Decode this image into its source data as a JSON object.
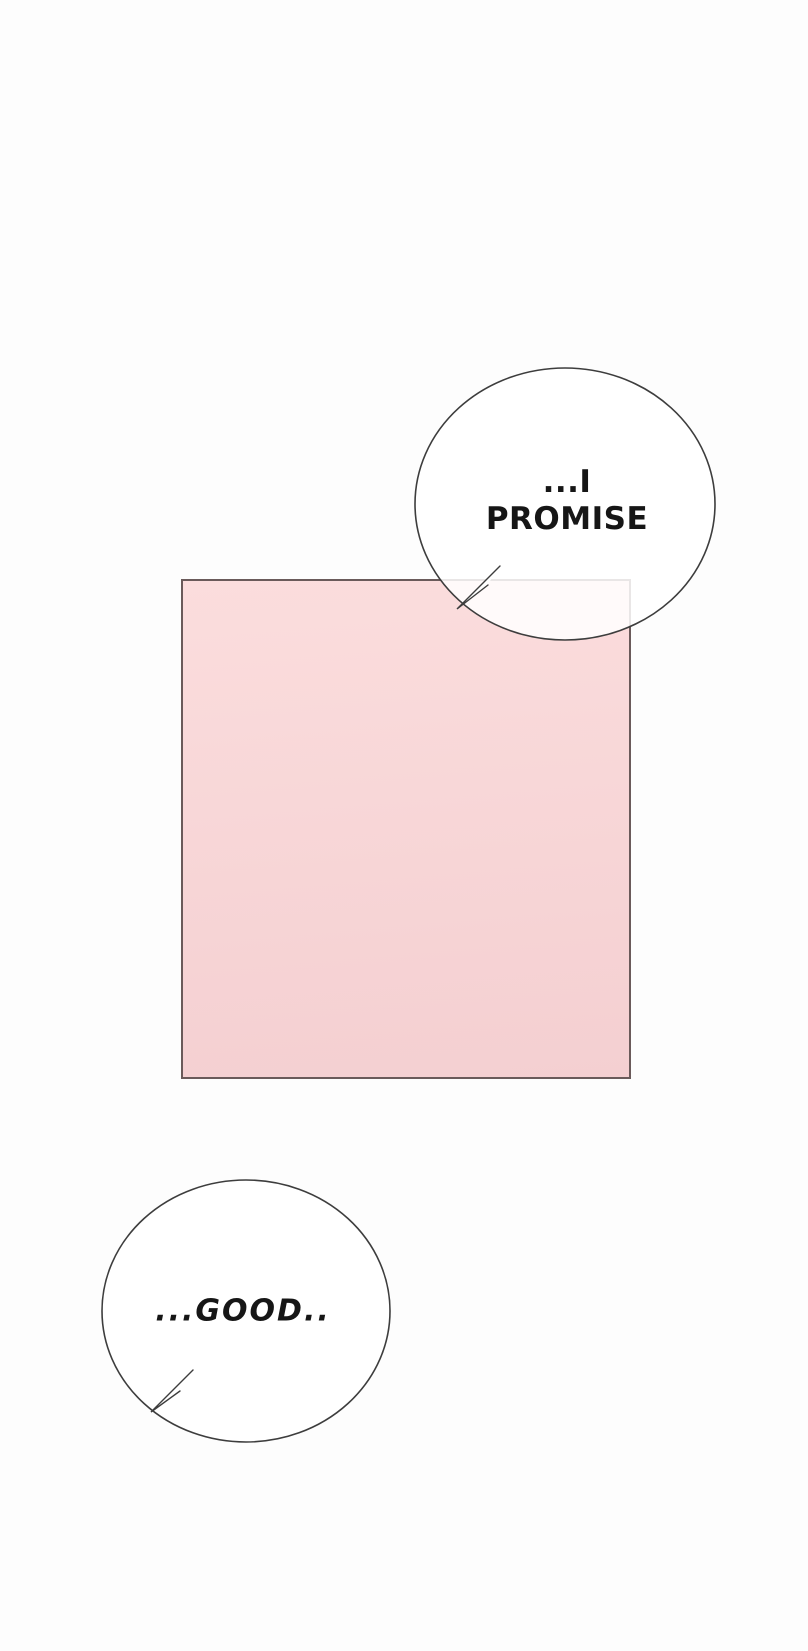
{
  "colors": {
    "page_bg": "#fdfdfd",
    "panel_fill_top": "#fbdddd",
    "panel_fill_bottom": "#f4cfd1",
    "panel_border": "#6a5a5a",
    "bubble_outline": "#3d3d3d",
    "bubble_fill": "rgba(255,255,255,0.85)",
    "bubble_fill_solid": "rgba(255,255,255,0.94)",
    "text_color": "#161616"
  },
  "speech": {
    "promise": {
      "line1": "...I",
      "line2": "PROMISE"
    },
    "good": {
      "text": "...GOOD.."
    }
  }
}
